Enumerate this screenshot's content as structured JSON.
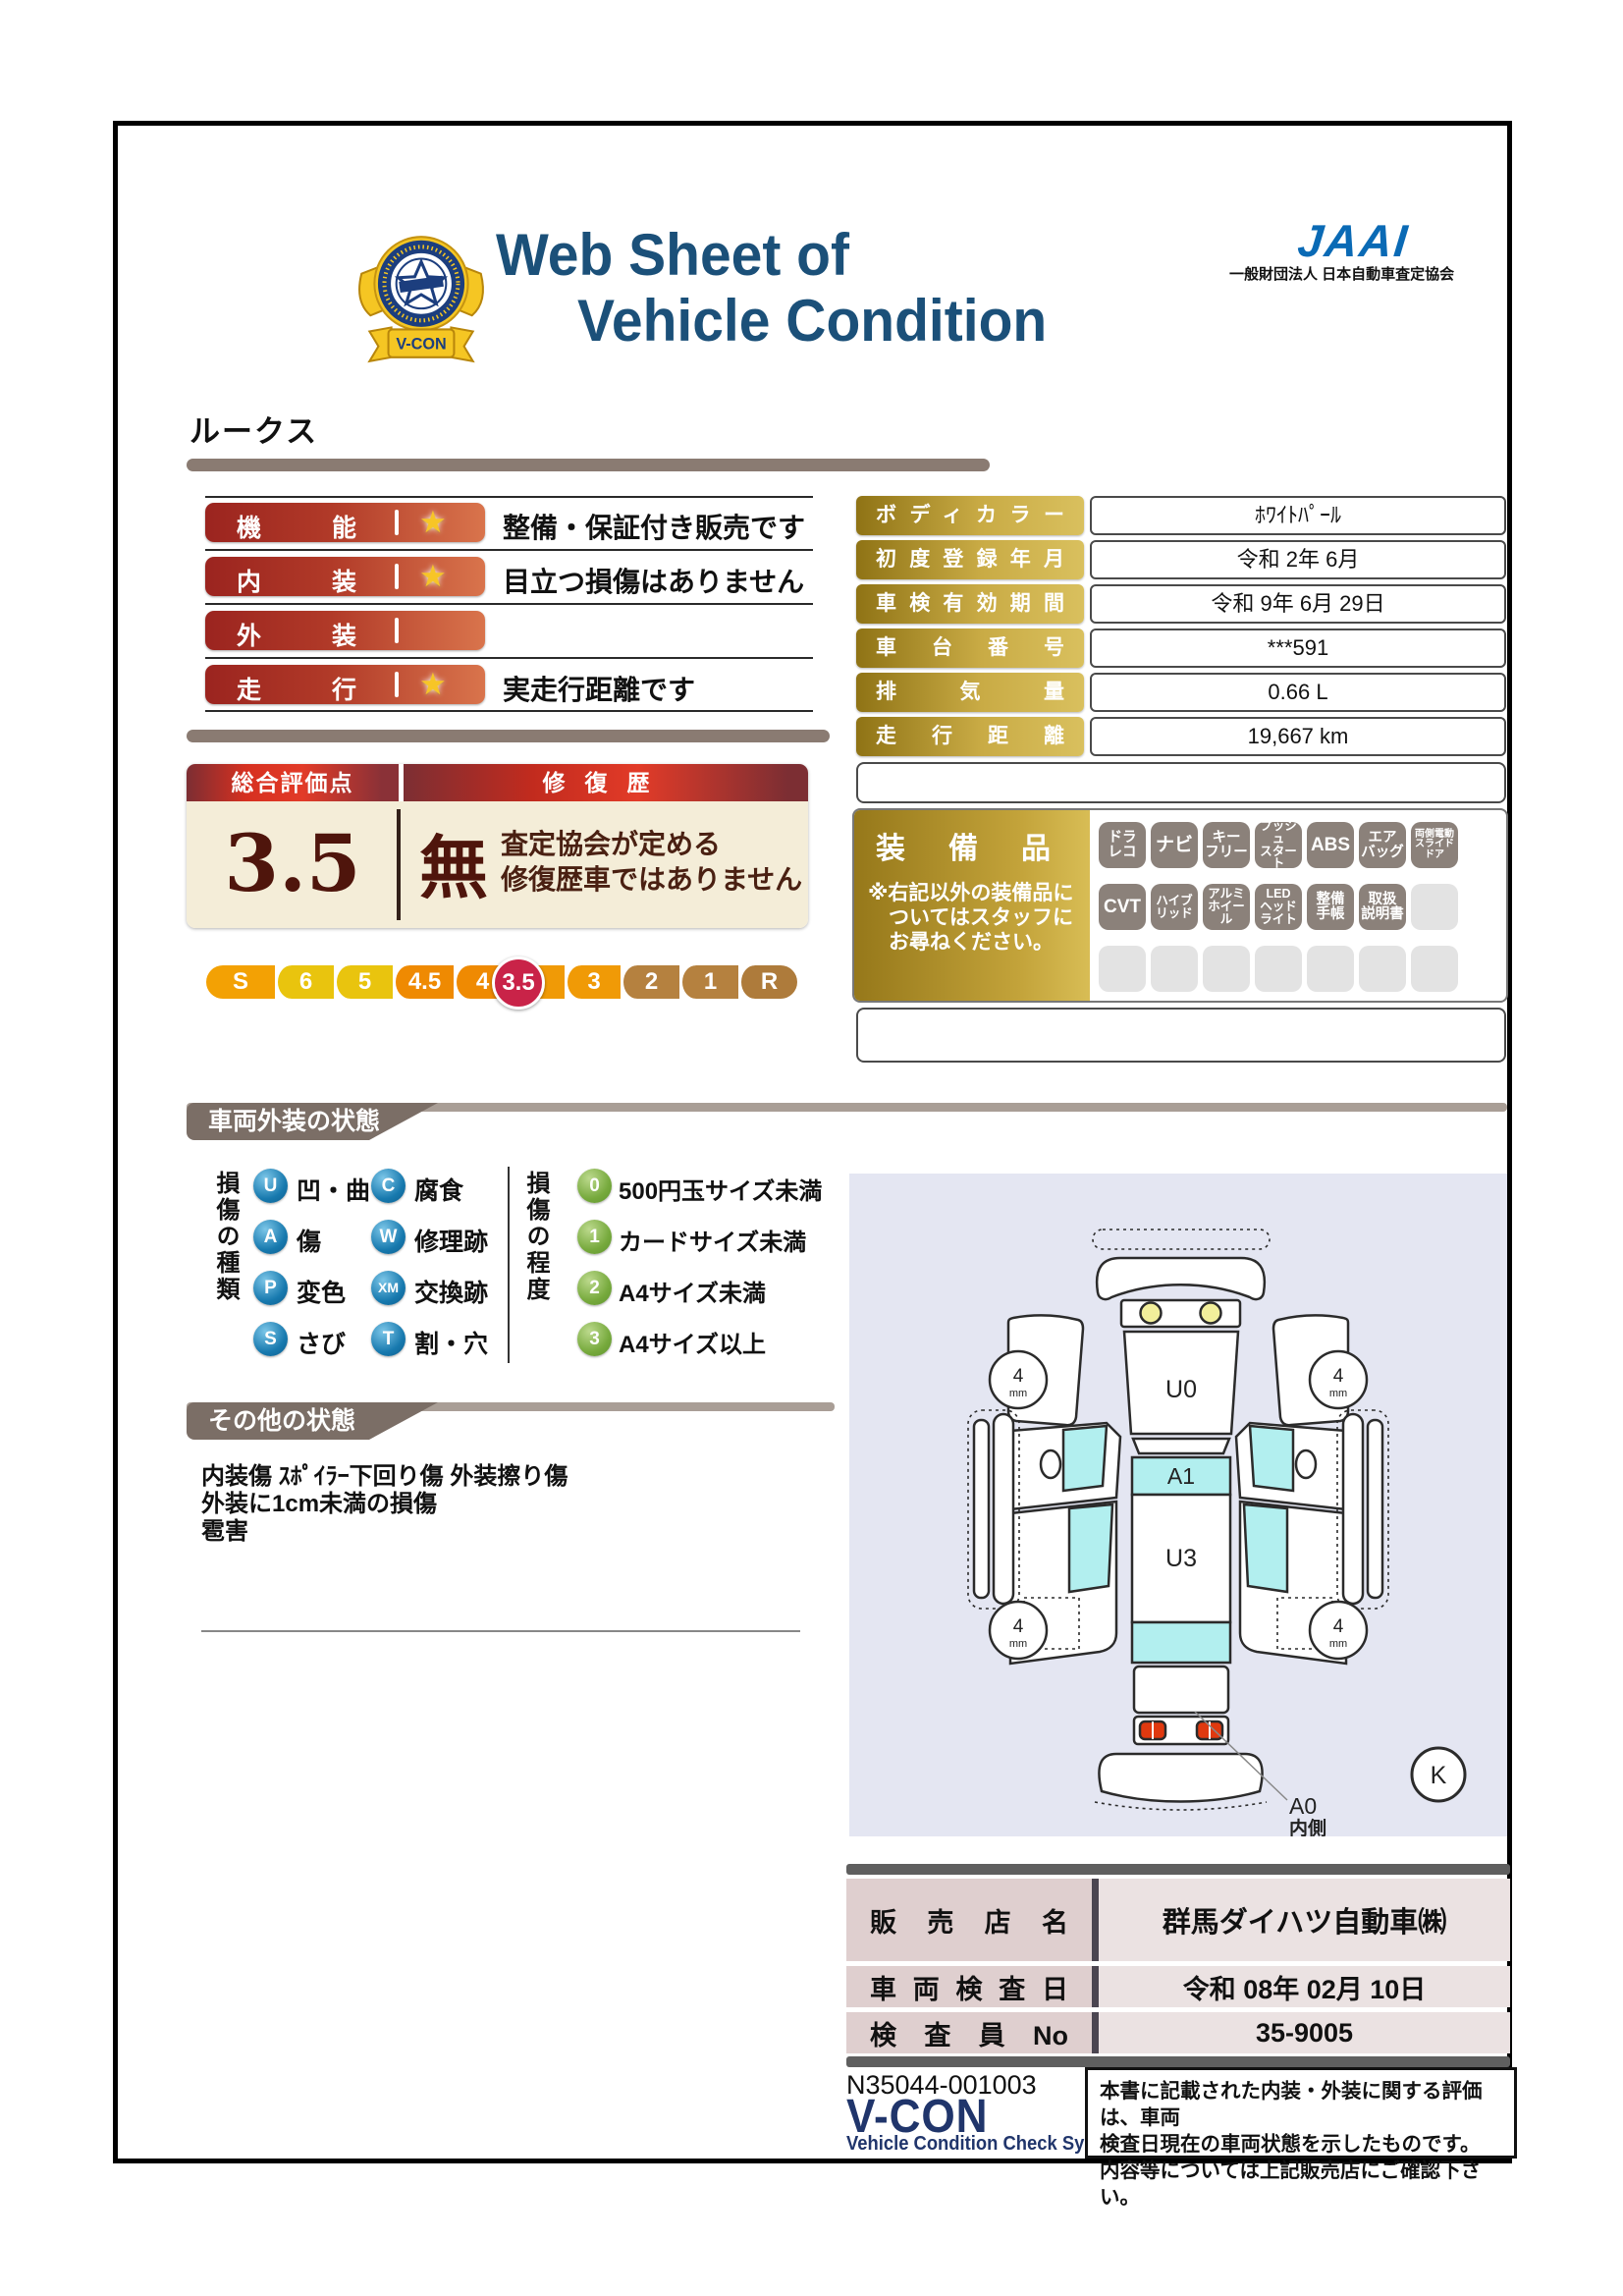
{
  "header": {
    "title_line1": "Web Sheet of",
    "title_line2": "Vehicle Condition",
    "crest_label": "V-CON",
    "jaai_logo_text": "JAAI",
    "jaai_subtitle": "一般財団法人 日本自動車査定協会"
  },
  "vehicle_name": "ルークス",
  "ratings": {
    "rows": [
      {
        "label": "機能",
        "star": "★",
        "note": "整備・保証付き販売です"
      },
      {
        "label": "内装",
        "star": "★",
        "note": "目立つ損傷はありません"
      },
      {
        "label": "外装",
        "star": "",
        "note": ""
      },
      {
        "label": "走行",
        "star": "★",
        "note": "実走行距離です"
      }
    ]
  },
  "overall": {
    "header_left": "総合評価点",
    "header_right": "修復歴",
    "score": "3.5",
    "repair_mark": "無",
    "repair_note": "査定協会が定める\n修復歴車ではありません",
    "scale": [
      {
        "label": "S",
        "color": "#f3a104"
      },
      {
        "label": "6",
        "color": "#e9c40e"
      },
      {
        "label": "5",
        "color": "#e9c40e"
      },
      {
        "label": "4.5",
        "color": "#ef8a02"
      },
      {
        "label": "4",
        "color": "#ef8a02"
      },
      {
        "label": "3.5",
        "color": "#c92348"
      },
      {
        "label": "3",
        "color": "#f09a06"
      },
      {
        "label": "2",
        "color": "#b5813f"
      },
      {
        "label": "1",
        "color": "#b5813f"
      },
      {
        "label": "R",
        "color": "#ae7b3b"
      }
    ]
  },
  "info_table": {
    "rows": [
      {
        "label": "ボディカラー",
        "value": "ﾎﾜｲﾄﾊﾟｰﾙ"
      },
      {
        "label": "初度登録年月",
        "value": "令和 2年 6月"
      },
      {
        "label": "車検有効期間",
        "value": "令和 9年 6月 29日"
      },
      {
        "label": "車台番号",
        "value": "***591"
      },
      {
        "label": "排気量",
        "value": "0.66 L"
      },
      {
        "label": "走行距離",
        "value": "19,667 km"
      }
    ]
  },
  "equipment": {
    "title": "装備品",
    "note": "※右記以外の装備品に\n　ついてはスタッフに\n　お尋ねください。",
    "rows": [
      [
        {
          "text": "ドラ\nレコ"
        },
        {
          "text": "ナビ"
        },
        {
          "text": "キー\nフリー"
        },
        {
          "text": "プッシュ\nスタート"
        },
        {
          "text": "ABS"
        },
        {
          "text": "エア\nバッグ"
        },
        {
          "text": "両側電動\nスライド\nドア"
        }
      ],
      [
        {
          "text": "CVT"
        },
        {
          "text": "ハイブ\nリッド"
        },
        {
          "text": "アルミ\nホイール"
        },
        {
          "text": "LED\nヘッド\nライト"
        },
        {
          "text": "整備\n手帳"
        },
        {
          "text": "取扱\n説明書"
        },
        {
          "text": ""
        }
      ],
      [
        {
          "text": ""
        },
        {
          "text": ""
        },
        {
          "text": ""
        },
        {
          "text": ""
        },
        {
          "text": ""
        },
        {
          "text": ""
        },
        {
          "text": ""
        }
      ]
    ]
  },
  "exterior": {
    "title": "車両外装の状態",
    "type_label": "損傷の種類",
    "types": [
      {
        "code": "U",
        "label": "凹・曲"
      },
      {
        "code": "A",
        "label": "傷"
      },
      {
        "code": "P",
        "label": "変色"
      },
      {
        "code": "S",
        "label": "さび"
      },
      {
        "code": "C",
        "label": "腐食"
      },
      {
        "code": "W",
        "label": "修理跡"
      },
      {
        "code": "XM",
        "label": "交換跡"
      },
      {
        "code": "T",
        "label": "割・穴"
      }
    ],
    "degree_label": "損傷の程度",
    "degrees": [
      {
        "code": "0",
        "label": "500円玉サイズ未満"
      },
      {
        "code": "1",
        "label": "カードサイズ未満"
      },
      {
        "code": "2",
        "label": "A4サイズ未満"
      },
      {
        "code": "3",
        "label": "A4サイズ以上"
      }
    ]
  },
  "other": {
    "title": "その他の状態",
    "notes": "内装傷 ｽﾎﾟｲﾗｰ下回り傷 外装擦り傷\n外装に1cm未満の損傷\n雹害"
  },
  "diagram": {
    "windshield_label": "U0",
    "roof_front_label": "A1",
    "roof_label": "U3",
    "tire_depth": "4",
    "tire_unit": "mm",
    "pointer_label": "A0",
    "pointer_sub": "内側",
    "key_label": "K"
  },
  "dealer": {
    "rows": [
      {
        "label": "販売店名",
        "value": "群馬ダイハツ自動車㈱"
      },
      {
        "label": "車両検査日",
        "value": "令和 08年 02月 10日"
      },
      {
        "label": "検査員No",
        "value": "35-9005"
      }
    ]
  },
  "footer": {
    "doc_number": "N35044-001003",
    "vcon_logo": "V-CON",
    "vcon_subtitle": "Vehicle Condition Check System",
    "disclaimer": "本書に記載された内装・外装に関する評価は、車両\n検査日現在の車両状態を示したものです。\n内容等については上記販売店にご確認下さい。"
  },
  "colors": {
    "title_navy": "#1b5079",
    "jaai_blue": "#0a6ab5",
    "rating_red": "#9b241f",
    "gold_label": "#b08f28",
    "cream": "#f4edd8",
    "banner_gray": "#7b6e66",
    "legend_blue": "#1779ae",
    "legend_green": "#76a93c",
    "diagram_bg": "#e4e6f2",
    "diagram_cyan": "#b2efef",
    "score_highlight": "#c92348"
  }
}
